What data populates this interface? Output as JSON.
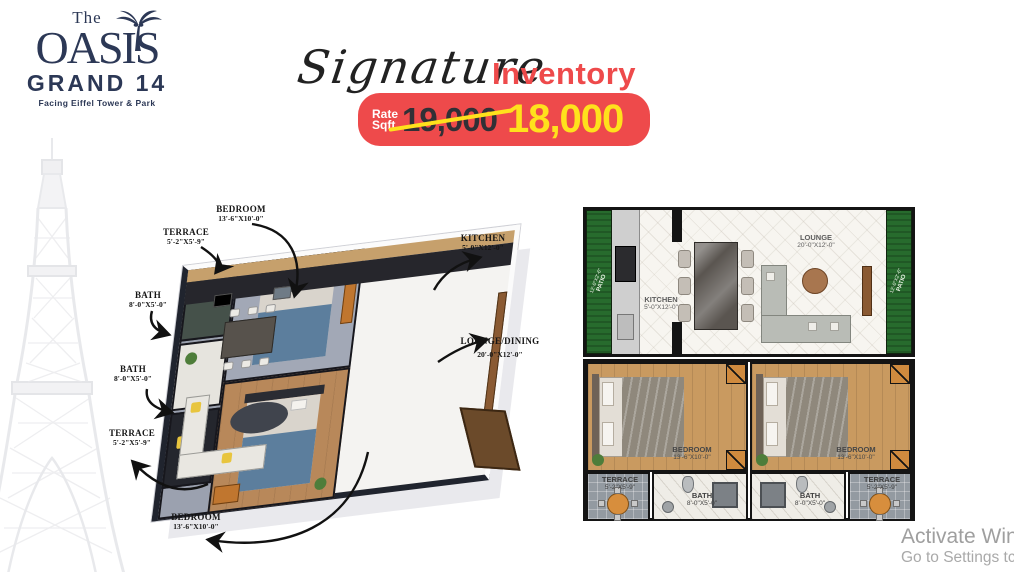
{
  "logo": {
    "the": "The",
    "name": "OASIS",
    "grand": "GRAND 14",
    "tagline": "Facing Eiffel Tower & Park"
  },
  "headline": {
    "script": "Signature",
    "accent": "Inventory"
  },
  "rate": {
    "label_top": "Rate",
    "label_bottom": "Sqft",
    "old": "19,000",
    "new": "18,000"
  },
  "colors": {
    "navy": "#2c3856",
    "red": "#ee4a4b",
    "yellow": "#ffe11c",
    "patio_green": "#276b2d"
  },
  "plan3d": {
    "labels": [
      {
        "name": "BEDROOM",
        "dims": "13'-6\"X10'-0\""
      },
      {
        "name": "TERRACE",
        "dims": "5'-2\"X5'-9\""
      },
      {
        "name": "BATH",
        "dims": "8'-0\"X5'-0\""
      },
      {
        "name": "BATH",
        "dims": "8'-0\"X5'-0\""
      },
      {
        "name": "TERRACE",
        "dims": "5'-2\"X5'-9\""
      },
      {
        "name": "BEDROOM",
        "dims": "13'-6\"X10'-0\""
      },
      {
        "name": "KITCHEN",
        "dims": "5'-0\"X12'-0\""
      },
      {
        "name": "LOUNGE/DINING",
        "dims": "20'-0\"X12'-0\""
      }
    ]
  },
  "plan2d": {
    "kitchen": {
      "name": "KITCHEN",
      "dims": "5'-0\"X12'-0\""
    },
    "lounge": {
      "name": "LOUNGE",
      "dims": "20'-0\"X12'-0\""
    },
    "patio_left": {
      "name": "PATIO",
      "dims": "12'-0\"X2'-6\""
    },
    "patio_right": {
      "name": "PATIO",
      "dims": "12'-0\"X2'-6\""
    },
    "bedroom_left": {
      "name": "BEDROOM",
      "dims": "13'-6\"X10'-0\""
    },
    "bedroom_right": {
      "name": "BEDROOM",
      "dims": "13'-6\"X10'-0\""
    },
    "terrace_left": {
      "name": "TERRACE",
      "dims": "5'-2\"X5'-9\""
    },
    "terrace_right": {
      "name": "TERRACE",
      "dims": "5'-2\"X5'-9\""
    },
    "bath_left": {
      "name": "BATH",
      "dims": "8'-0\"X5'-0\""
    },
    "bath_right": {
      "name": "BATH",
      "dims": "8'-0\"X5'-0\""
    }
  },
  "watermark": {
    "line1": "Activate Win",
    "line2": "Go to Settings tc"
  }
}
